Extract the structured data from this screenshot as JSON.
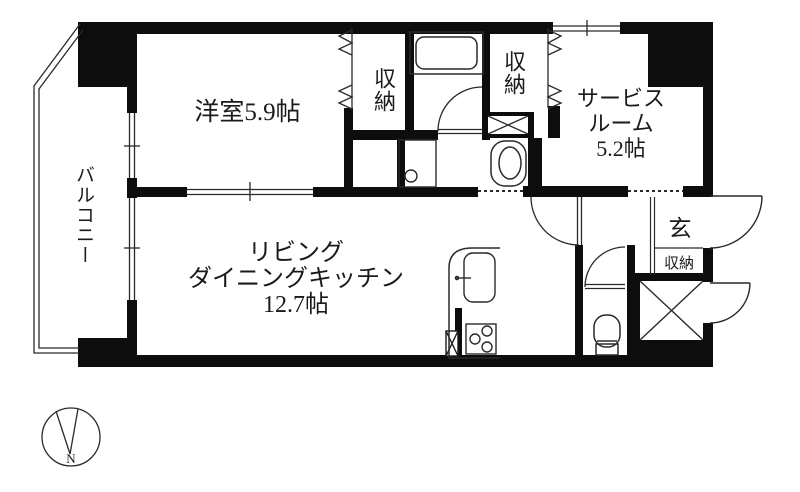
{
  "floorplan": {
    "background": "#ffffff",
    "wall_color": "#0d0d0d",
    "line_color": "#2a2a2a",
    "rooms": {
      "western_room": {
        "label": "洋室5.9帖"
      },
      "ldk": {
        "lines": [
          "リビング",
          "ダイニングキッチン",
          "12.7帖"
        ]
      },
      "service_room": {
        "lines": [
          "サービス",
          "ルーム",
          "5.2帖"
        ]
      },
      "balcony": {
        "label": "バルコニー"
      },
      "entrance": {
        "label": "玄"
      },
      "entrance_storage": {
        "label": "収納"
      },
      "closet_west": {
        "label": "収納"
      },
      "closet_east": {
        "label": "収納"
      }
    },
    "compass": {
      "north_label": "N"
    },
    "fixtures": [
      "bathtub",
      "washing-machine-pan",
      "washbasin",
      "toilet",
      "kitchen-counter",
      "kitchen-sink",
      "gas-stove",
      "pipe-space",
      "meter-box",
      "entrance-door",
      "folding-closet-doors"
    ]
  }
}
